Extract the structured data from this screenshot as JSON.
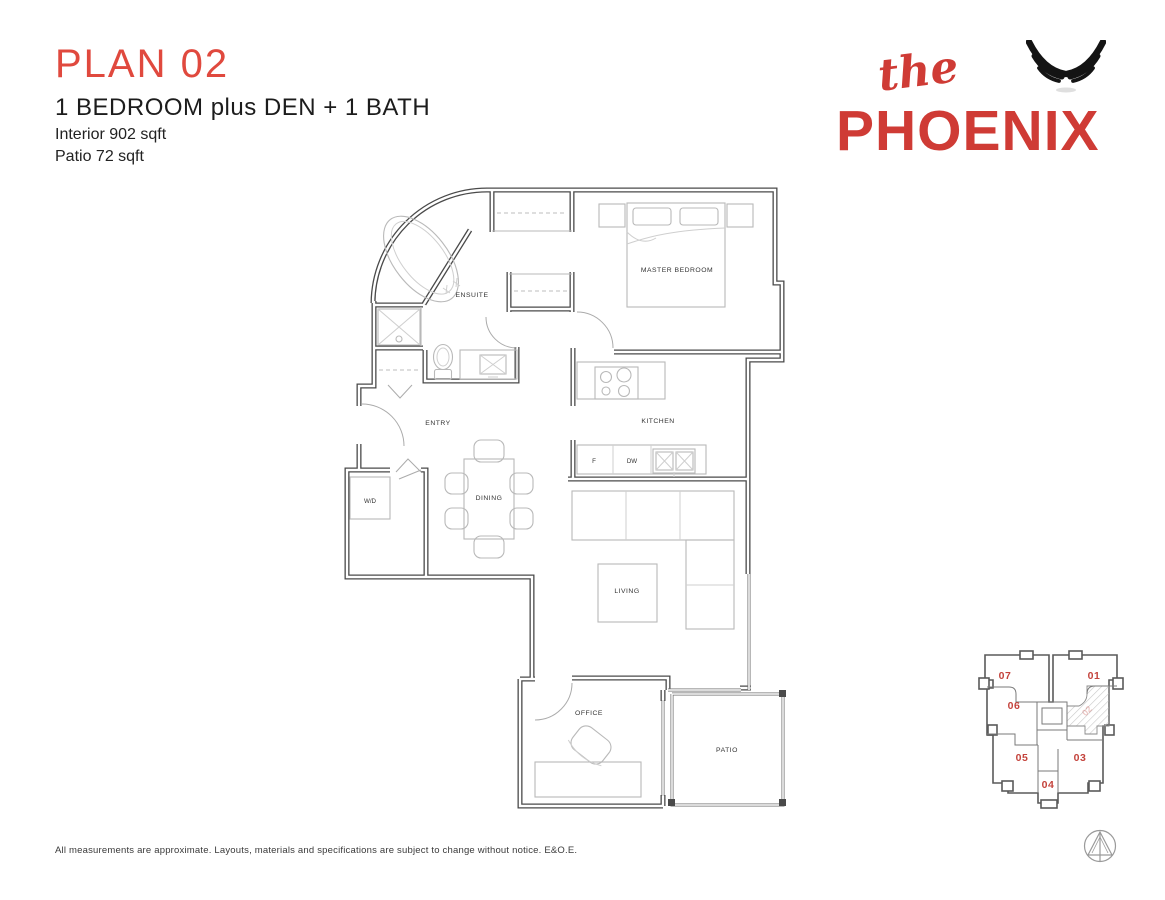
{
  "header": {
    "plan_title": "PLAN 02",
    "plan_type": "1 BEDROOM plus DEN + 1 BATH",
    "interior_area": "Interior 902 sqft",
    "patio_area": "Patio 72 sqft"
  },
  "logo": {
    "prefix": "the",
    "name": "PHOENIX",
    "icon": "phoenix-wings-icon"
  },
  "floorplan": {
    "labels": {
      "master_bedroom": "MASTER BEDROOM",
      "ensuite": "ENSUITE",
      "entry": "ENTRY",
      "kitchen": "KITCHEN",
      "dining": "DINING",
      "living": "LIVING",
      "office": "OFFICE",
      "patio": "PATIO",
      "washer_dryer": "W/D",
      "fridge": "F",
      "dishwasher": "DW"
    }
  },
  "keyplan": {
    "units": {
      "u07": "07",
      "u01": "01",
      "u06": "06",
      "u05": "05",
      "u03": "03",
      "u04": "04"
    },
    "highlighted_unit": "02"
  },
  "disclaimer": "All measurements are approximate. Layouts, materials and specifications are subject to change without notice. E&O.E.",
  "colors": {
    "title_red": "#e0493e",
    "logo_red": "#cf3b35",
    "keyplan_red": "#c4433c",
    "wall_gray": "#4a4a4a",
    "furniture_gray": "#b9b9b9"
  }
}
